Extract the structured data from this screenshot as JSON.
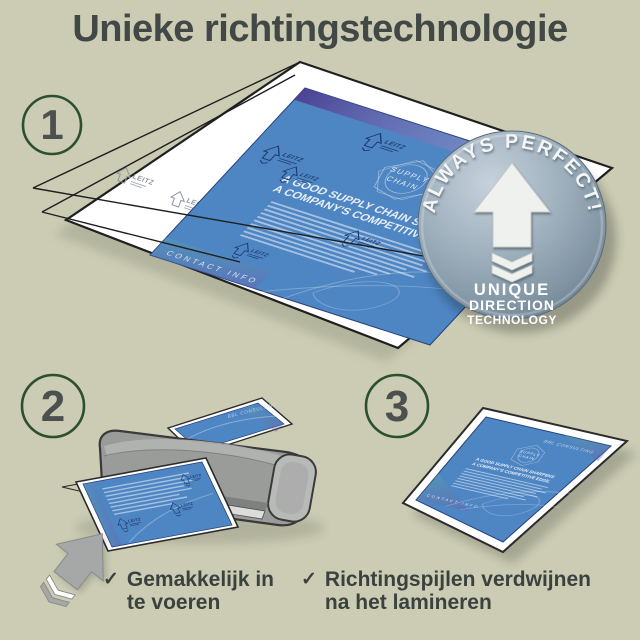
{
  "title": "Unieke richtingstechnologie",
  "colors": {
    "background": "#cbccb3",
    "title_text": "#414845",
    "step_circle": "#2c4f30",
    "step_number": "#4c5150",
    "check_text": "#3a423f",
    "flyer_blue": "#4e86c4",
    "laminator_gray": "#9a9c9a",
    "arrow_gray": "#a5a8a7",
    "badge_base": "#8da1b0"
  },
  "steps": [
    {
      "number": "1"
    },
    {
      "number": "2"
    },
    {
      "number": "3"
    }
  ],
  "badge": {
    "curved_text": "ALWAYS PERFECT!",
    "line1": "UNIQUE",
    "line2": "DIRECTION",
    "line3": "TECHNOLOGY",
    "arrow_icon": "up-arrow-with-chevrons"
  },
  "flyer": {
    "brand": "BBL CONSULTING",
    "logo_line1": "SUPPLY",
    "logo_line2": "CHAIN",
    "heading_line1": "A GOOD SUPPLY CHAIN SHARPENS",
    "heading_line2": "A COMPANY'S COMPETITIVE EDGE.",
    "footer": "CONTACT INFO",
    "pouch_watermark": "LEITZ"
  },
  "checklist": {
    "check_glyph": "✓",
    "items": [
      {
        "line1": "Gemakkelijk in",
        "line2": "te voeren"
      },
      {
        "line1": "Richtingspijlen verdwijnen",
        "line2": "na het lamineren"
      }
    ]
  }
}
